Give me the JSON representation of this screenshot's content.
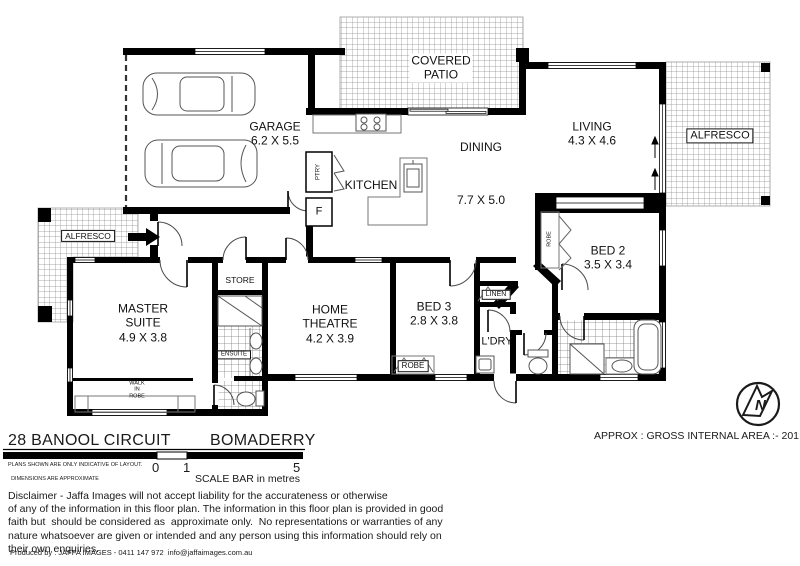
{
  "header": {
    "address": "28 BANOOL CIRCUIT",
    "suburb": "BOMADERRY"
  },
  "area_note": "APPROX : GROSS INTERNAL AREA :- 201 SQM",
  "compass": {
    "label": "N"
  },
  "rooms": {
    "garage": {
      "label": "GARAGE",
      "dims": "6.2 X 5.5"
    },
    "covered_patio": {
      "line1": "COVERED",
      "line2": "PATIO"
    },
    "kitchen": {
      "label": "KITCHEN"
    },
    "dining": {
      "label": "DINING",
      "dims": "7.7 X 5.0"
    },
    "living": {
      "label": "LIVING",
      "dims": "4.3 X 4.6"
    },
    "alfresco_right": {
      "label": "ALFRESCO"
    },
    "alfresco_left": {
      "label": "ALFRESCO"
    },
    "master_suite": {
      "line1": "MASTER",
      "line2": "SUITE",
      "dims": "4.9 X 3.8"
    },
    "walk_in_robe": {
      "line1": "WALK",
      "line2": "IN",
      "line3": "ROBE"
    },
    "ensuite": {
      "label": "ENSUITE"
    },
    "store": {
      "label": "STORE"
    },
    "home_theatre": {
      "line1": "HOME",
      "line2": "THEATRE",
      "dims": "4.2 X 3.9"
    },
    "bed3": {
      "label": "BED 3",
      "dims": "2.8 X 3.8"
    },
    "bed2": {
      "label": "BED 2",
      "dims": "3.5 X 3.4"
    },
    "laundry": {
      "label": "L'DRY"
    },
    "linen": {
      "label": "LINEN"
    },
    "robe_bed3": {
      "label": "ROBE"
    },
    "robe_bed2": {
      "label": "ROBE"
    },
    "pantry": {
      "label": "PTRY"
    },
    "fridge": {
      "label": "F"
    }
  },
  "scale_bar": {
    "tick0": "0",
    "tick1": "1",
    "tick5": "5",
    "caption": "SCALE BAR in metres"
  },
  "notes": {
    "line1": "PLANS SHOWN ARE ONLY INDICATIVE OF LAYOUT.",
    "line2": "DIMENSIONS ARE APPROXIMATE"
  },
  "disclaimer": {
    "line1": "Disclaimer - Jaffa Images will not accept liability for the accurateness or otherwise",
    "line2": "of any of the information in this floor plan. The information in this floor plan is provided in good",
    "line3": "faith but  should be considered as  approximate only.  No representations or warranties of any",
    "line4": "nature whatsoever are given or intended and any person using this information should rely on",
    "line5": "their own enquiries."
  },
  "produced_by": "Produced by : JAFFA IMAGES - 0411 147 972  info@jaffaimages.com.au",
  "colors": {
    "wall": "#000000",
    "hatch_line": "#8d8d8d",
    "fixture_line": "#555555"
  }
}
